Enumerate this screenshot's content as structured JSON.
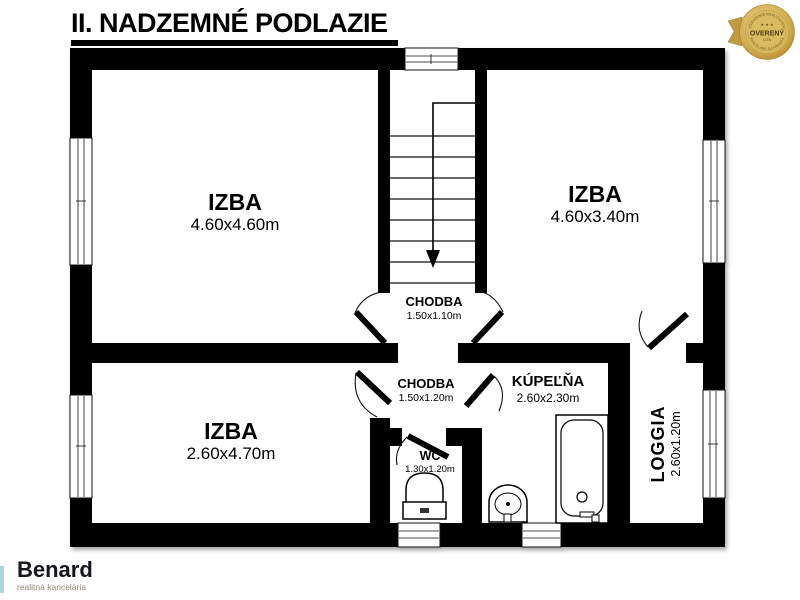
{
  "page": {
    "title": "II. NADZEMNÉ PODLAZIE"
  },
  "badge": {
    "arc_top": "ZDRUŽENIE REALITNÝCH",
    "arc_bottom": "KANCELÁRIÍ SLOVENSKA",
    "stars": "★ ★ ★",
    "label": "OVERENÝ",
    "sublabel": "ČLEN"
  },
  "rooms": {
    "izba_top_left": {
      "name": "IZBA",
      "dims": "4.60x4.60m"
    },
    "izba_top_right": {
      "name": "IZBA",
      "dims": "4.60x3.40m"
    },
    "chodba_upper": {
      "name": "CHODBA",
      "dims": "1.50x1.10m"
    },
    "chodba_lower": {
      "name": "CHODBA",
      "dims": "1.50x1.20m"
    },
    "kupelna": {
      "name": "KÚPEĽŇA",
      "dims": "2.60x2.30m"
    },
    "izba_bottom_left": {
      "name": "IZBA",
      "dims": "2.60x4.70m"
    },
    "wc": {
      "name": "WC",
      "dims": "1.30x1.20m"
    },
    "loggia": {
      "name": "LOGGIA",
      "dims": "2.60x1.20m"
    }
  },
  "logo": {
    "name": "Benard",
    "tagline": "realitná kancelária"
  },
  "colors": {
    "wall": "#000000",
    "badge_gold": "#c9a84c",
    "logo_accent": "#aed3e3"
  }
}
